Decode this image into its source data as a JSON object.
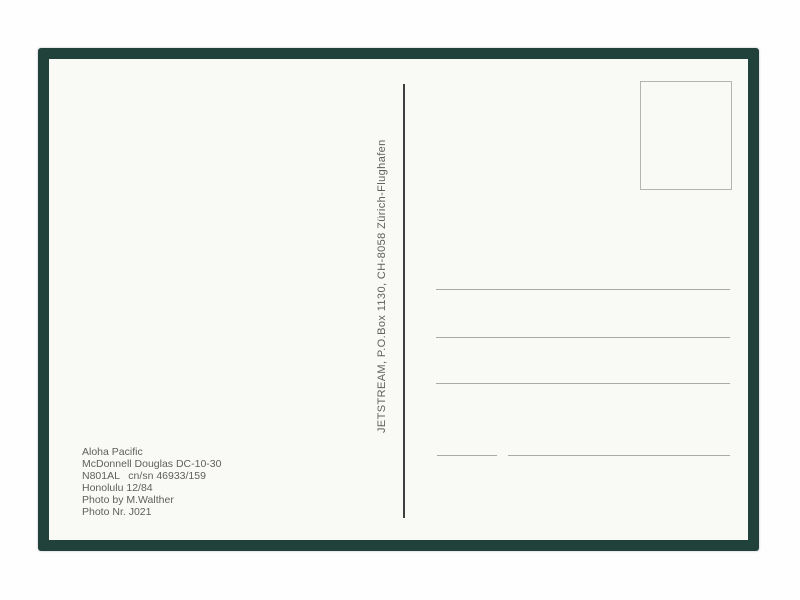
{
  "postcard": {
    "publisher_line": "JETSTREAM, P.O.Box 1130, CH-8058 Zürich-Flughafen",
    "caption": {
      "lines": [
        "Aloha Pacific",
        "McDonnell Douglas DC-10-30",
        "N801AL   cn/sn 46933/159",
        "Honolulu 12/84",
        "Photo by M.Walther",
        "Photo Nr. J021"
      ]
    },
    "address_rules": {
      "full_lines": 3,
      "split_bottom_line_segments": 2
    },
    "colors": {
      "card_border": "#20423b",
      "paper": "#f9f9f5",
      "divider": "#3f3f3f",
      "address_line": "#a9a9a9",
      "stamp_border": "#b3b3b3",
      "text": "#5f5f5f"
    }
  }
}
